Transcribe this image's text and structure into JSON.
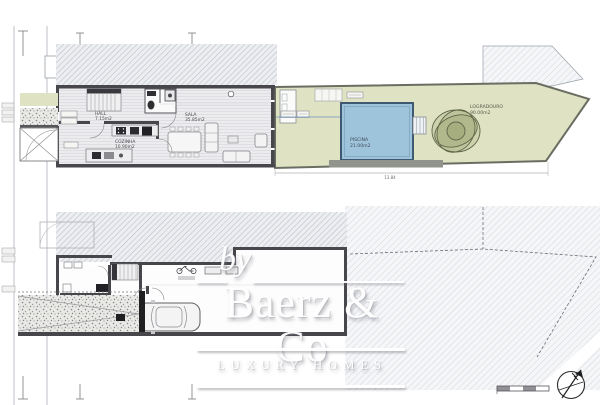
{
  "plans": {
    "ground_floor": {
      "rooms": [
        {
          "name": "HALL",
          "area": "7.15m2"
        },
        {
          "name": "COZINHA",
          "area": "10.90m2"
        },
        {
          "name": "SALA",
          "area": "35.85m2"
        }
      ]
    },
    "garden": {
      "items": [
        {
          "name": "PISCINA",
          "area": "21.00m2"
        },
        {
          "name": "LOGRADOURO",
          "area": "90.00m2"
        }
      ]
    },
    "dimensions": {
      "total_length": "13.84"
    }
  },
  "watermark": {
    "by": "by",
    "brand": "Baerz & Co",
    "tagline": "LUXURY HOMES"
  },
  "colors": {
    "garden_fill": "#dfe3c3",
    "pool_fill": "#9ec4dc",
    "wall": "#46464b",
    "hatch_line": "#b8bcc4",
    "watermark": "#ffffff"
  },
  "icons": {
    "north_arrow": "north-arrow-icon",
    "tree": "tree-icon",
    "car": "car-icon",
    "bicycle": "bicycle-icon",
    "scale_bar": "scale-bar"
  }
}
